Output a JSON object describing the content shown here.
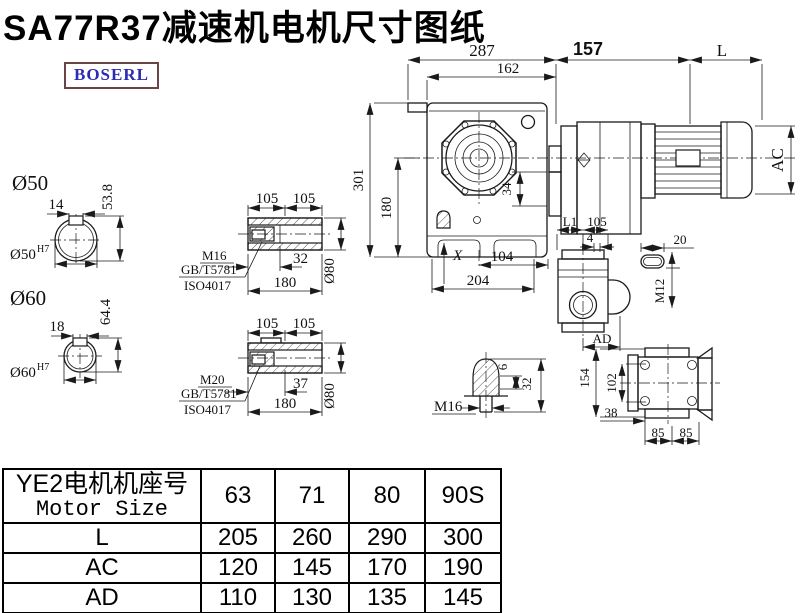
{
  "title": "SA77R37减速机电机尺寸图纸",
  "logo": "BOSERL",
  "colors": {
    "line": "#1a1a1a",
    "logo_text": "#2b2bb4",
    "logo_border": "#6a4548",
    "background": "#ffffff"
  },
  "main_view": {
    "dim_287": "287",
    "dim_162": "162",
    "dim_157": "157",
    "dim_L": "L",
    "dim_301": "301",
    "dim_180": "180",
    "dim_34": "34",
    "dim_X": "X",
    "dim_104": "104",
    "dim_204": "204",
    "dim_AC": "AC"
  },
  "shaft_50": {
    "label": "Ø50",
    "dim_14": "14",
    "dim_53_8": "53.8",
    "bore_label": "Ø50",
    "bore_sup": "H7"
  },
  "shaft_60": {
    "label": "Ø60",
    "dim_18": "18",
    "dim_64_4": "64.4",
    "bore_label": "Ø60",
    "bore_sup": "H7"
  },
  "bushing_top": {
    "dim_105a": "105",
    "dim_105b": "105",
    "thread": "M16",
    "std1": "GB/T5781",
    "std2": "ISO4017",
    "dim_32": "32",
    "dim_180": "180",
    "dim_d80": "Ø80"
  },
  "bushing_bottom": {
    "dim_105a": "105",
    "dim_105b": "105",
    "thread": "M20",
    "std1": "GB/T5781",
    "std2": "ISO4017",
    "dim_37": "37",
    "dim_180": "180",
    "dim_d80": "Ø80"
  },
  "plug_detail": {
    "thread": "M16",
    "dim_6": "6",
    "dim_32": "32"
  },
  "side_view": {
    "dim_L1": "L1",
    "dim_105": "105",
    "dim_4": "4",
    "dim_AD": "AD"
  },
  "key_detail": {
    "dim_20": "20",
    "thread": "M12"
  },
  "back_view": {
    "dim_154": "154",
    "dim_102": "102",
    "dim_38": "38",
    "dim_85a": "85",
    "dim_85b": "85"
  },
  "table": {
    "header_cn": "YE2电机机座号",
    "header_en": "Motor Size",
    "columns": [
      "63",
      "71",
      "80",
      "90S"
    ],
    "rows": [
      {
        "label": "L",
        "values": [
          "205",
          "260",
          "290",
          "300"
        ]
      },
      {
        "label": "AC",
        "values": [
          "120",
          "145",
          "170",
          "190"
        ]
      },
      {
        "label": "AD",
        "values": [
          "110",
          "130",
          "135",
          "145"
        ]
      }
    ]
  }
}
